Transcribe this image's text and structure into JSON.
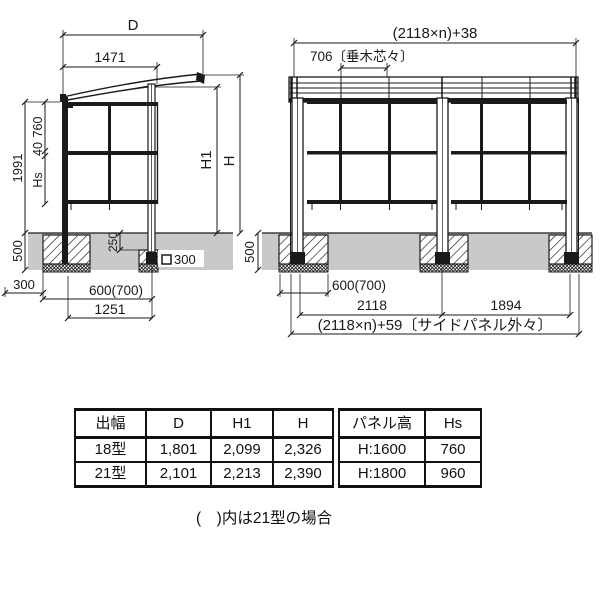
{
  "side_view": {
    "dim_d": "D",
    "dim_roof_width": "1471",
    "dim_height_total": "1991",
    "dim_panel_upper": "760",
    "dim_panel_gap": "40",
    "dim_panel_hs": "Hs",
    "dim_h1": "H1",
    "dim_h": "H",
    "dim_ground_depth": "500",
    "dim_footing_top": "250",
    "dim_footing_square": "300",
    "dim_edge": "300",
    "dim_embed": "600(700)",
    "dim_post_pitch": "1251"
  },
  "front_view": {
    "dim_total_top": "(2118×n)+38",
    "dim_rafter_pitch": "706〔垂木芯々〕",
    "dim_ground_depth": "500",
    "dim_embed": "600(700)",
    "dim_bay": "2118",
    "dim_end_bay": "1894",
    "dim_total_bottom": "(2118×n)+59〔サイドパネル外々〕"
  },
  "spec_table": {
    "headers": [
      "出幅",
      "D",
      "H1",
      "H"
    ],
    "rows": [
      [
        "18型",
        "1,801",
        "2,099",
        "2,326"
      ],
      [
        "21型",
        "2,101",
        "2,213",
        "2,390"
      ]
    ]
  },
  "panel_table": {
    "headers": [
      "パネル高",
      "Hs"
    ],
    "rows": [
      [
        "H:1600",
        "760"
      ],
      [
        "H:1800",
        "960"
      ]
    ]
  },
  "note": "(　)内は21型の場合"
}
